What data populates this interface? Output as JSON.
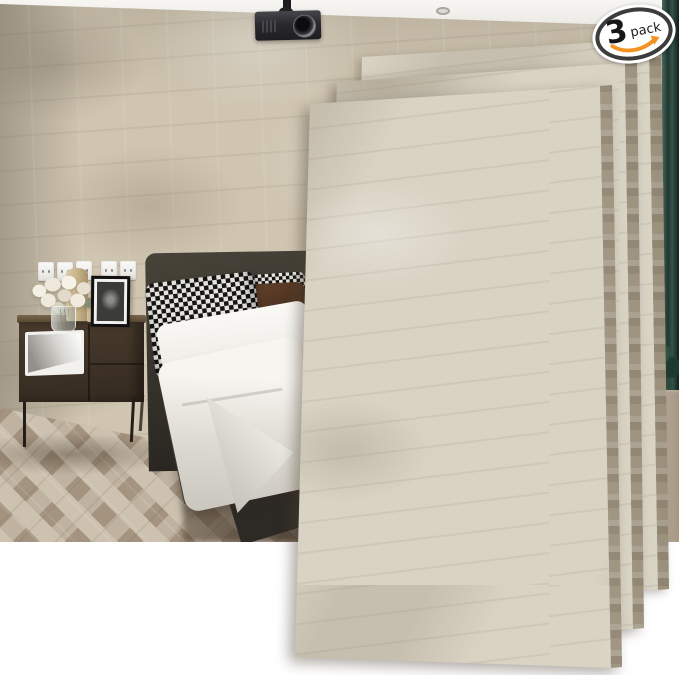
{
  "badge": {
    "count": "3",
    "unit": "pack"
  },
  "panels": {
    "visible_count": 3
  },
  "scene": {
    "objects": [
      "white ceiling with recessed light",
      "ceiling-mounted projector",
      "beige faux-stone accent wall",
      "five white wall outlets",
      "white flowers in glass vase",
      "two tan candles",
      "black picture frame with monochrome photo",
      "dark walnut nightstand with white open shelf",
      "bed with charcoal upholstered headboard",
      "houndstooth pillows and chocolate brown pillow",
      "white duvet draped over mattress",
      "herringbone wood floor",
      "dark green curtain",
      "green plant",
      "beige lounge seat",
      "three overlapping faux-stone wall panels fanned over the scene"
    ]
  },
  "colors": {
    "wall_base": "#cfc5b1",
    "panel_face": "#d9d3c4",
    "panel_edge": "#b2a792",
    "ceiling_white": "#f7f6f3",
    "floor_light": "#cdc1b0",
    "floor_mid": "#bfb2a0",
    "floor_dark": "#a3937f",
    "headboard": "#39362f",
    "bedframe_dark": "#2d2a26",
    "duvet_white": "#f6f5f0",
    "duvet_shadow": "#cbc8bf",
    "pillow_dark": "#151515",
    "pillow_light": "#e6e4dd",
    "pillow_brown_hi": "#5c3d28",
    "pillow_brown_lo": "#2f1d10",
    "wood_dark": "#4a3b2d",
    "wood_darker": "#342a20",
    "white_box": "#f2f1ee",
    "candle": "#ccb88f",
    "curtain_dark": "#1f3630",
    "curtain_light": "#35544c",
    "plant_green": "#2c4a3b",
    "sofa_beige": "#a49683",
    "amazon_orange": "#f39220",
    "badge_ink": "#161616",
    "badge_ring": "#3c3c3c"
  }
}
